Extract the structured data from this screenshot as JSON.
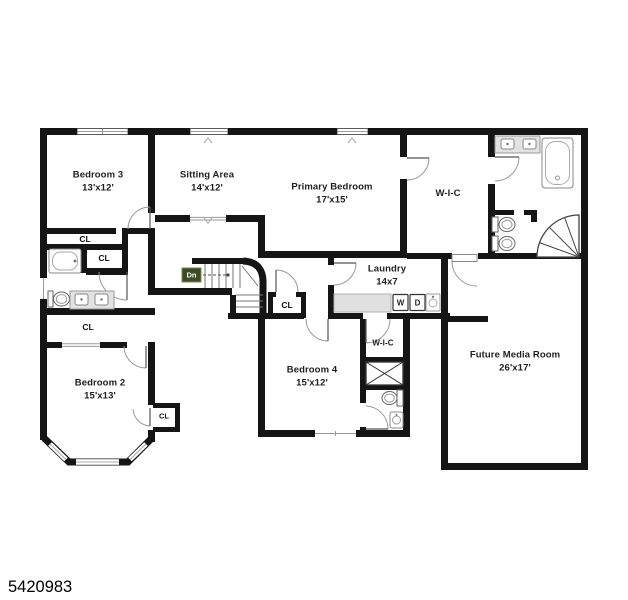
{
  "photo_id": "5420983",
  "plan": {
    "closet_label": "CL",
    "stairs": {
      "down_label": "Dn"
    },
    "laundry_appliances": {
      "washer": "W",
      "dryer": "D"
    },
    "rooms": [
      {
        "id": "bedroom-3",
        "name": "Bedroom 3",
        "dims": "13'x12'"
      },
      {
        "id": "sitting-area",
        "name": "Sitting Area",
        "dims": "14'x12'"
      },
      {
        "id": "primary-bedroom",
        "name": "Primary Bedroom",
        "dims": "17'x15'"
      },
      {
        "id": "primary-walk-in-closet",
        "name": "W-I-C",
        "dims": ""
      },
      {
        "id": "laundry",
        "name": "Laundry",
        "dims": "14x7"
      },
      {
        "id": "bedroom-2",
        "name": "Bedroom 2",
        "dims": "15'x13'"
      },
      {
        "id": "bedroom-4",
        "name": "Bedroom 4",
        "dims": "15'x12'"
      },
      {
        "id": "bedroom-4-walk-in-closet",
        "name": "W-I-C",
        "dims": ""
      },
      {
        "id": "future-media-room",
        "name": "Future Media Room",
        "dims": "26'x17'"
      }
    ]
  }
}
